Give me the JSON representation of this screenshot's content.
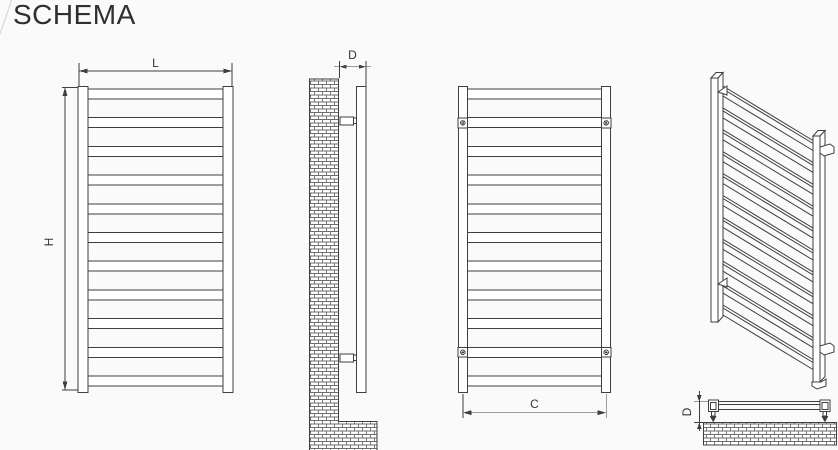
{
  "title": "SCHEMA",
  "colors": {
    "line": "#3f3f3f",
    "background": "#fafafa",
    "text": "#2f2f2f"
  },
  "diagram": {
    "dimension_labels": {
      "width": "L",
      "height": "H",
      "depth": "D",
      "connections": "C",
      "depth_detail": "D"
    },
    "views": {
      "front": {
        "name": "front view",
        "tube_count": 11
      },
      "side": {
        "name": "side view on wall",
        "bracket_count": 2
      },
      "rear": {
        "name": "rear view",
        "tube_count": 11,
        "mount_plate_count": 4
      },
      "isometric": {
        "name": "isometric view",
        "tube_count": 11
      },
      "top_detail": {
        "name": "top mounting detail"
      }
    }
  }
}
